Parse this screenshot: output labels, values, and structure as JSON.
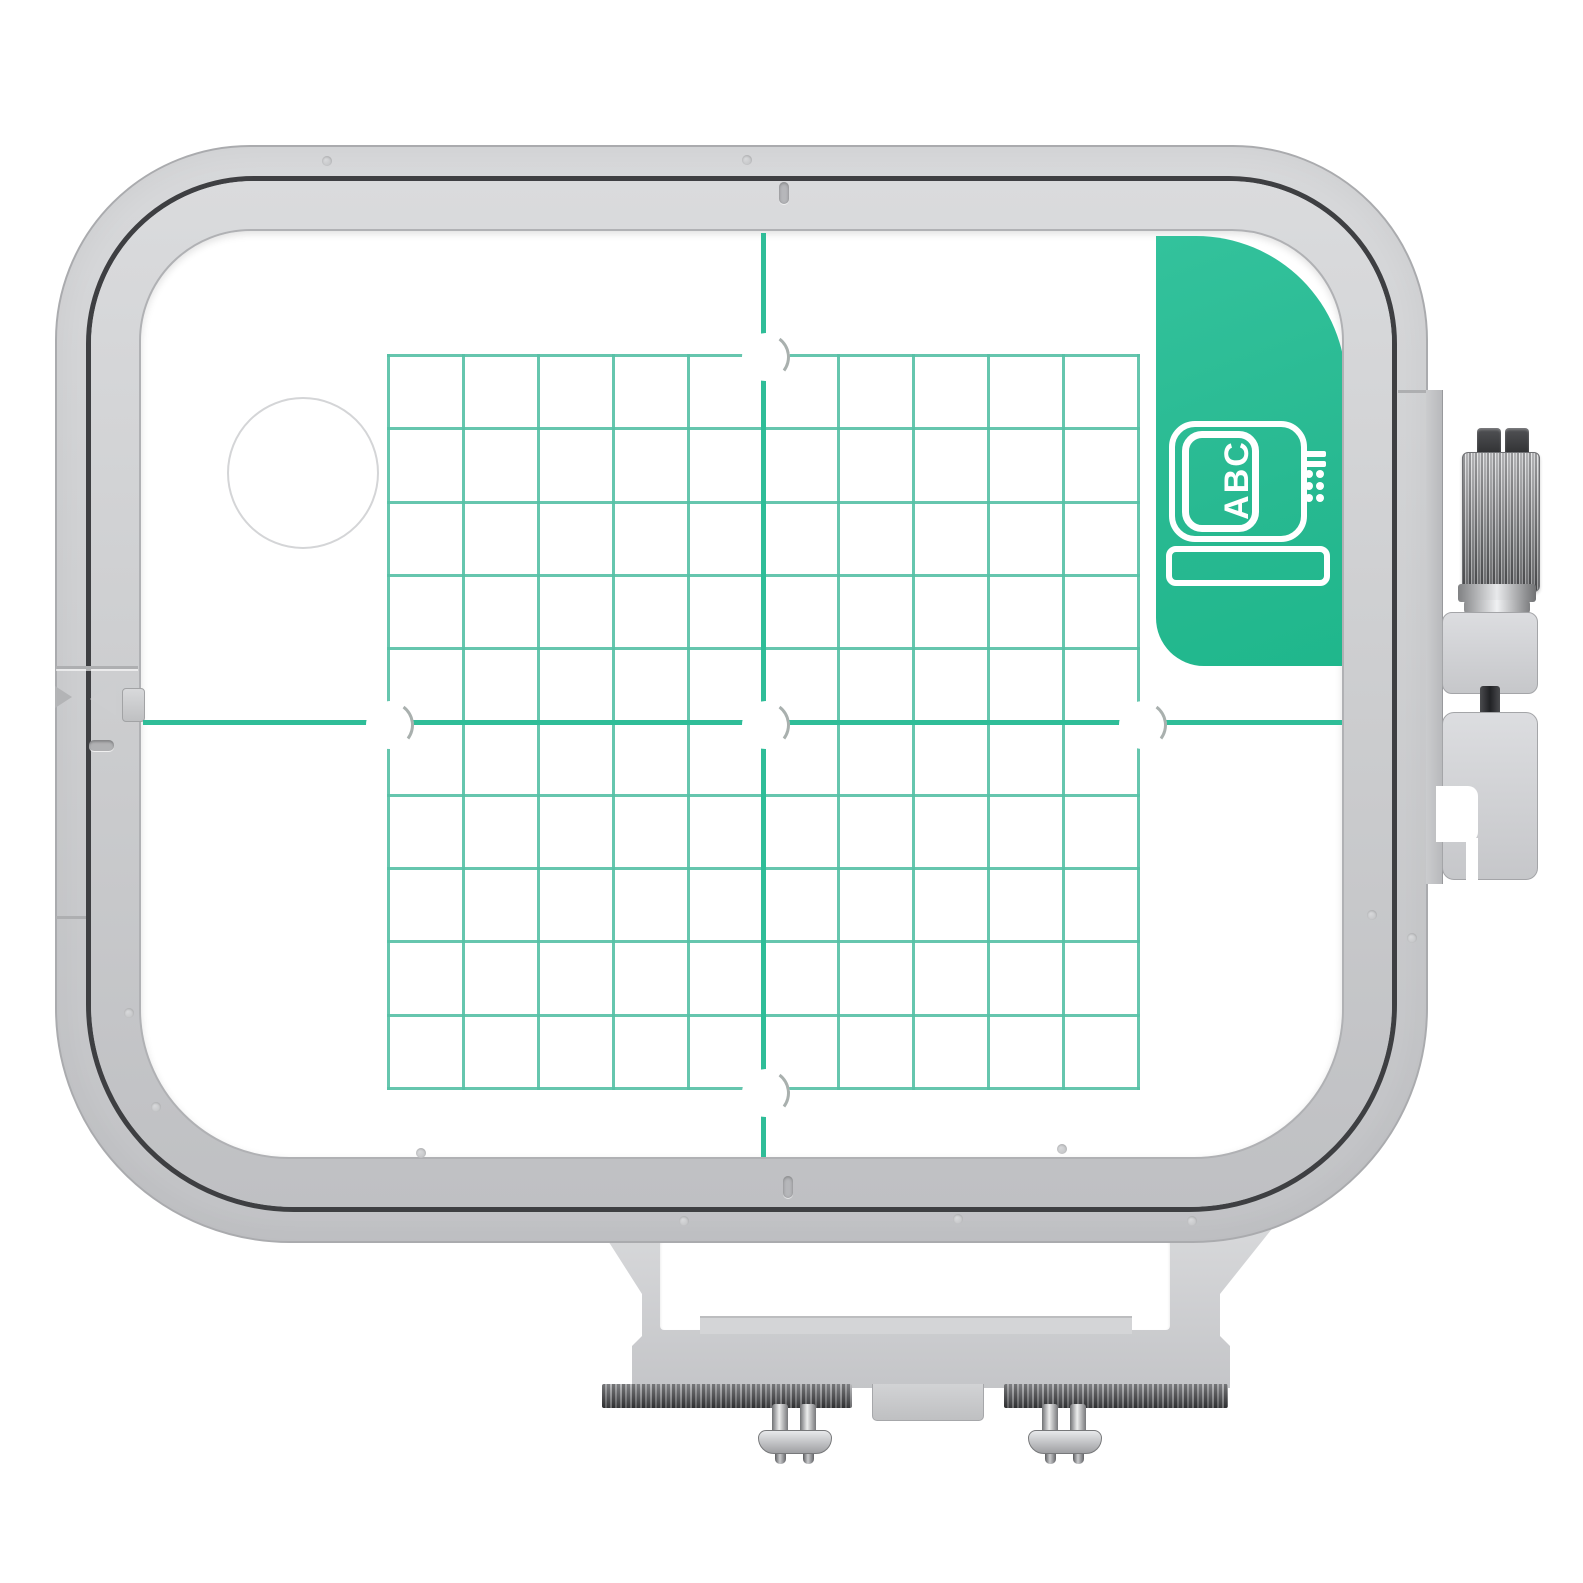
{
  "scene": {
    "description": "Gray plastic machine-embroidery hoop with teal positioning grid template, green ABC corner tab, side thumbscrew clamp and bottom mounting bracket with two screws",
    "background": "#ffffff"
  },
  "colors": {
    "bg": "#ffffff",
    "frame": "#cfd0d2",
    "frame_hi": "#d8d9db",
    "frame_lo": "#c4c5c8",
    "frame_edge": "#aaabae",
    "gap": "#3e3f42",
    "grid_line": "#55c0a5",
    "center_line": "#2fbd98",
    "tab_green": "#28b991",
    "tab_green_hi": "#33c29c",
    "metal_light": "#eceded",
    "metal_mid": "#8e8f92",
    "metal_dark": "#46474a"
  },
  "tab": {
    "label": "ABC"
  },
  "grid": {
    "cols": 10,
    "rows": 10,
    "line_px": 3
  },
  "template": {
    "big_hole": {
      "x": 160,
      "y": 240
    },
    "holes": [
      {
        "x": 622,
        "y": 123
      },
      {
        "x": 246,
        "y": 491
      },
      {
        "x": 622,
        "y": 491
      },
      {
        "x": 999,
        "y": 491
      },
      {
        "x": 622,
        "y": 859
      }
    ]
  },
  "frame": {
    "mold_dots": [
      [
        327,
        161
      ],
      [
        747,
        160
      ],
      [
        684,
        1221
      ],
      [
        958,
        1219
      ],
      [
        1192,
        1221
      ],
      [
        156,
        1107
      ],
      [
        129,
        1013
      ],
      [
        1062,
        1149
      ],
      [
        421,
        1153
      ],
      [
        1372,
        915
      ],
      [
        1412,
        938
      ]
    ]
  }
}
